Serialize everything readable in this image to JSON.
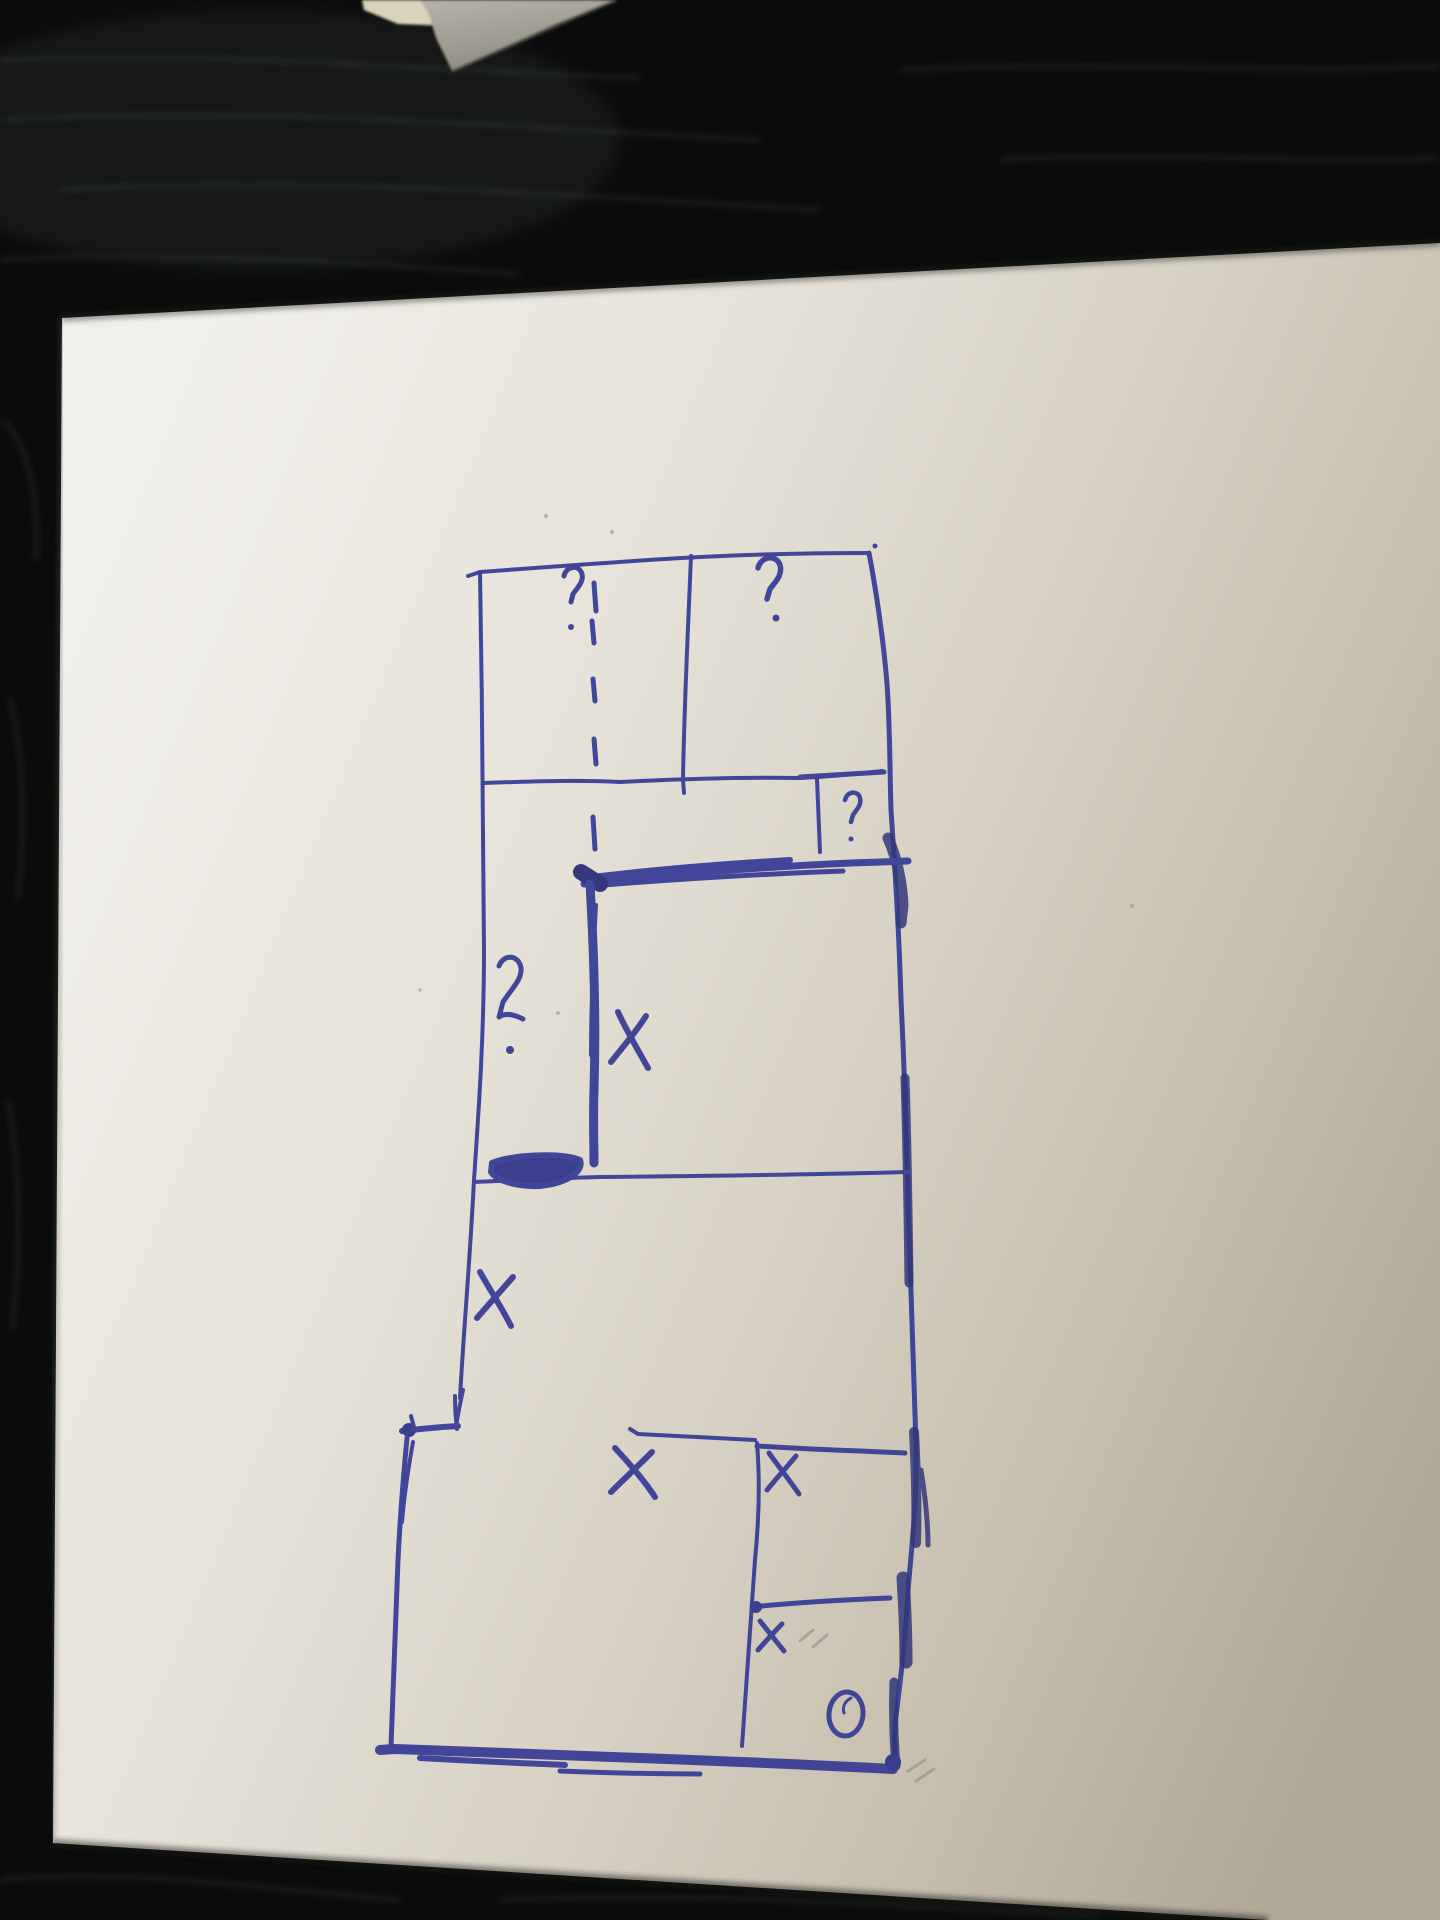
{
  "scene": {
    "description": "Hand-drawn floor-plan style sketch in blue ballpoint pen on a sheet of white paper lying on a dark black wooden table, photographed from above. A grey object corner intrudes at the top edge.",
    "table_color": "#0b0d0c",
    "wood_streak_color": "#3d443f",
    "paper_color_light": "#f0eeea",
    "paper_color_shaded": "#b0a796",
    "pen_color": "#3a3e96",
    "pen_dark_color": "#2c2f78",
    "pencil_color": "#8d897b",
    "object": {
      "label": "grey object corner",
      "grey": "#a9a59a",
      "cream": "#d8d3ba"
    }
  },
  "sketch": {
    "title": "floor plan sketch",
    "marks": [
      {
        "id": "question-top-left-room",
        "label": "?"
      },
      {
        "id": "question-top-right-room",
        "label": "?"
      },
      {
        "id": "question-small-room",
        "label": "?"
      },
      {
        "id": "question-left-strip",
        "label": "?"
      },
      {
        "id": "x-middle-room",
        "label": "X"
      },
      {
        "id": "x-left-strip",
        "label": "X"
      },
      {
        "id": "x-bottom-left-room",
        "label": "X"
      },
      {
        "id": "x-bottom-right-room",
        "label": "X"
      },
      {
        "id": "x-bottom-small-room",
        "label": "x"
      },
      {
        "id": "circle-bottom-right",
        "label": "O"
      }
    ]
  }
}
